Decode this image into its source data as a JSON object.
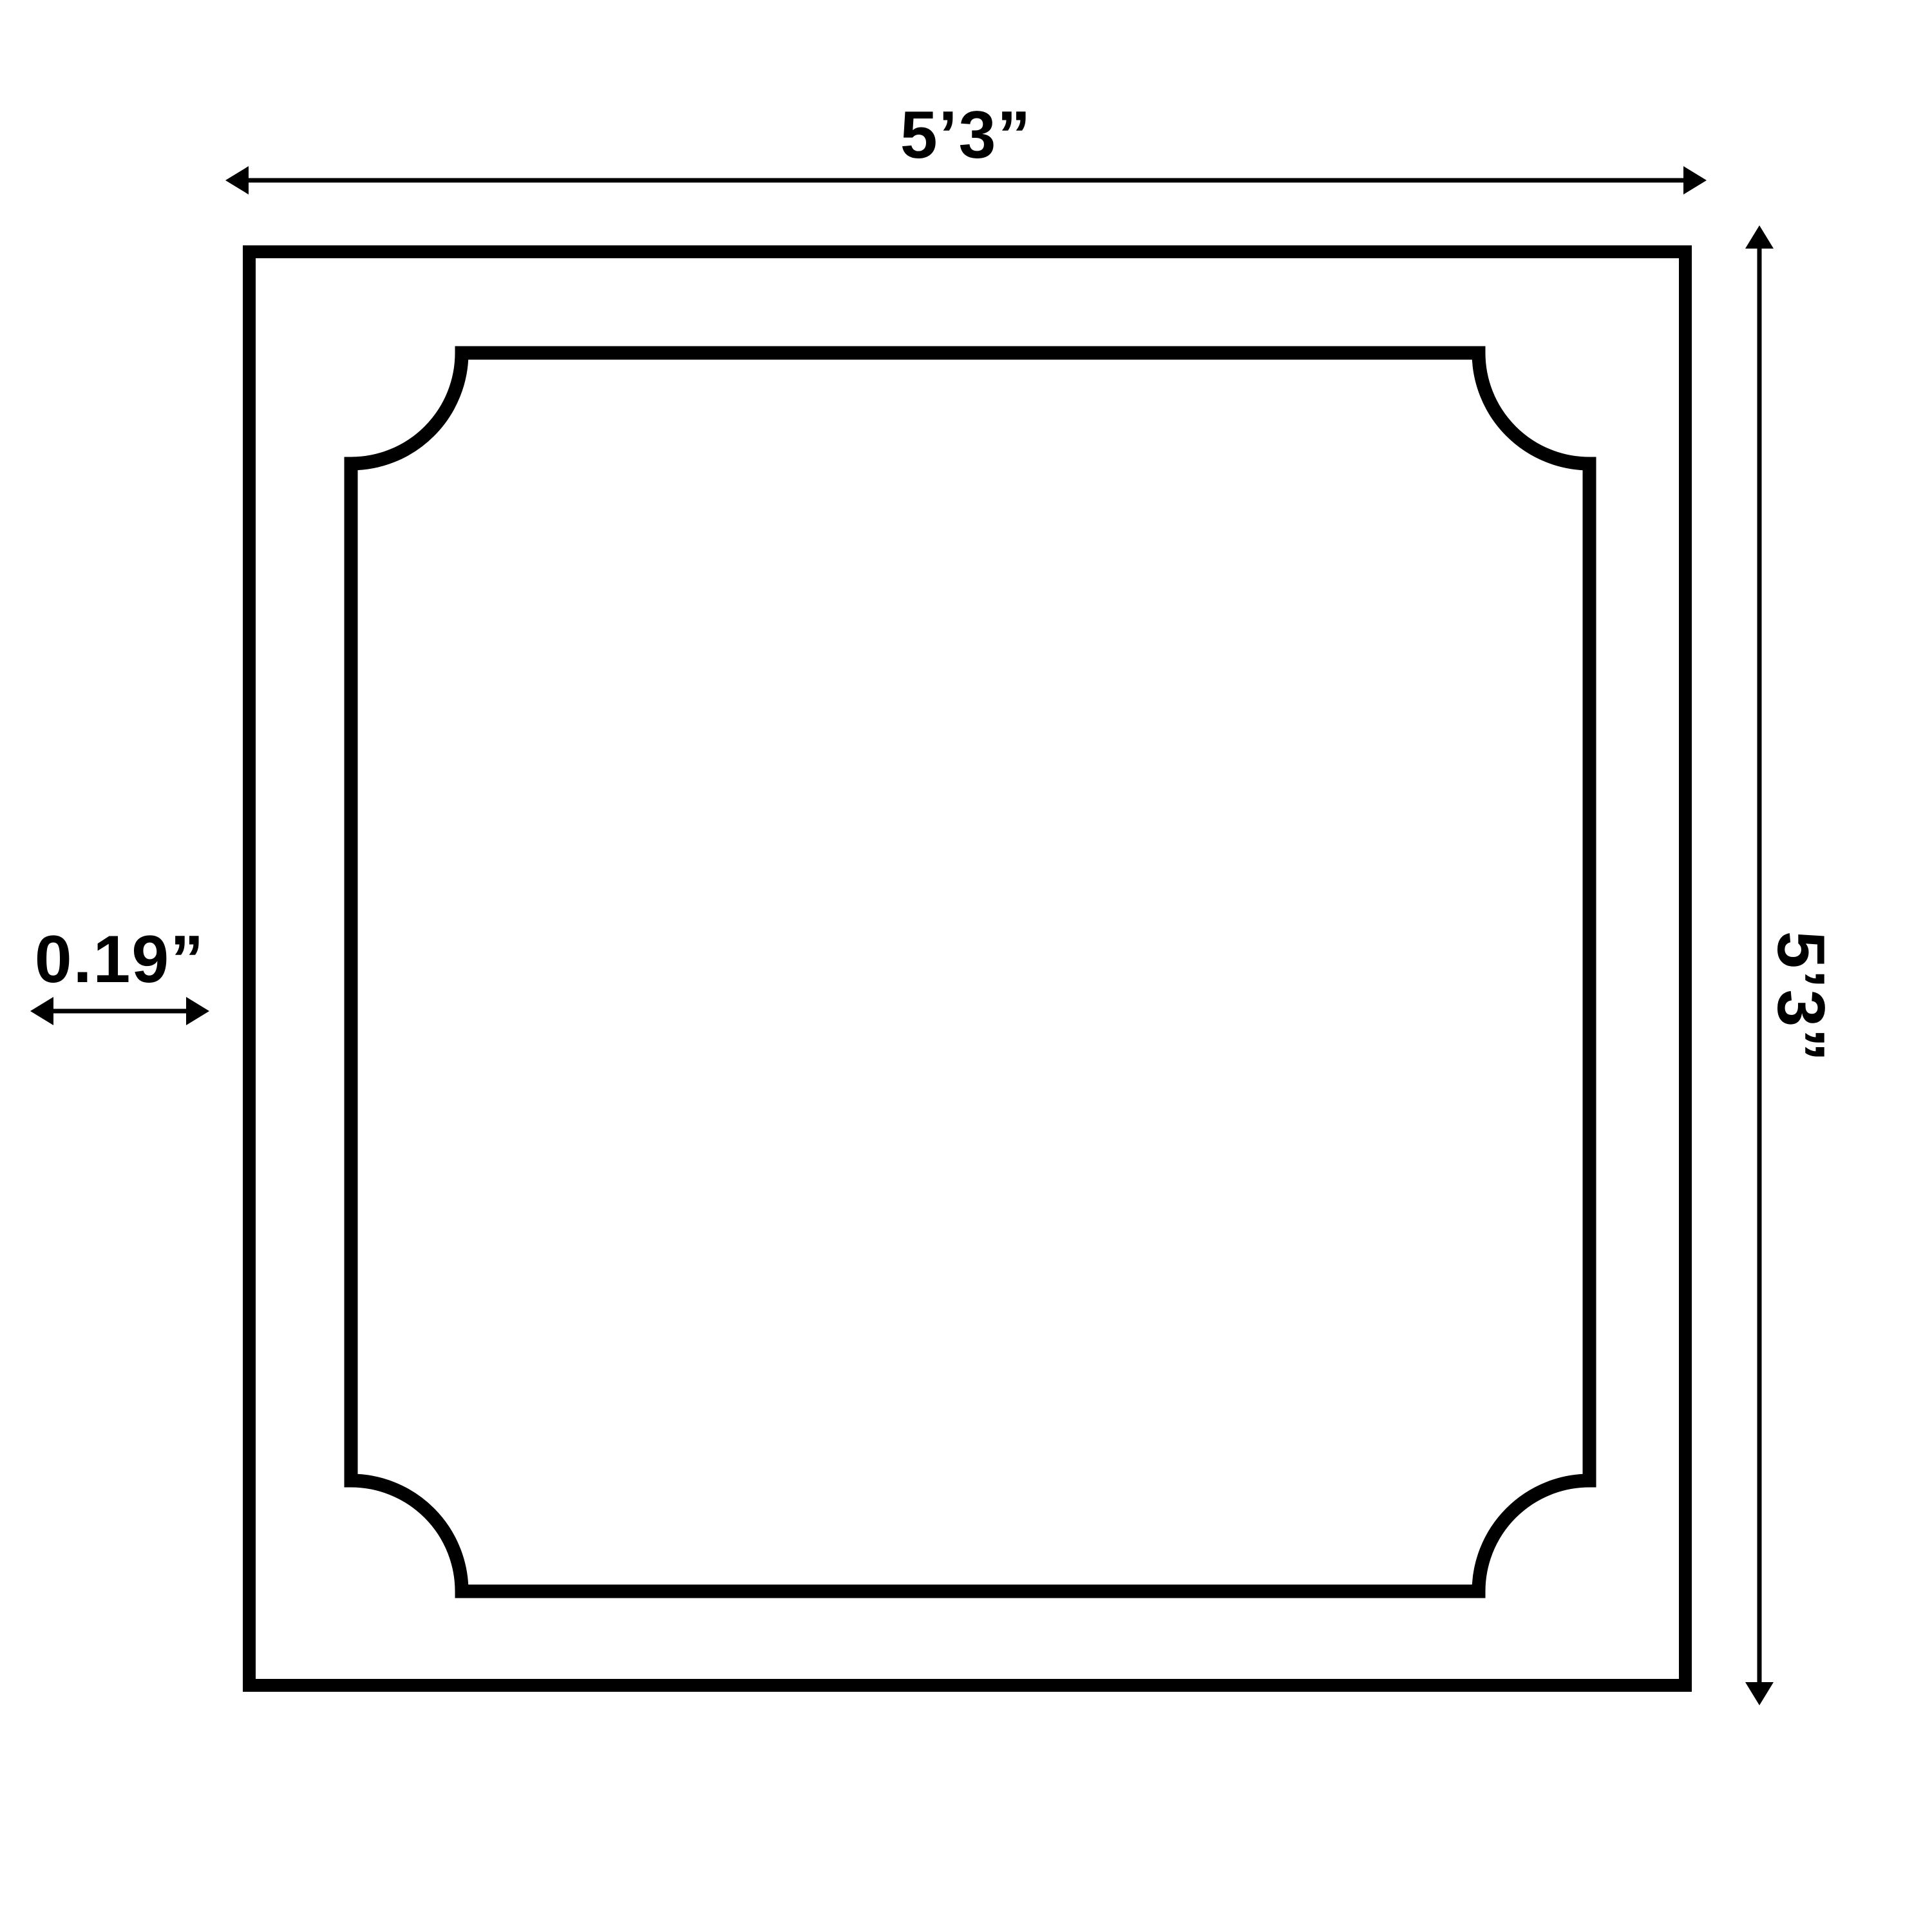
{
  "page": {
    "background": "#ffffff"
  },
  "diagram": {
    "line_color": "#000000",
    "labels": {
      "width": "5’3”",
      "height": "5’3”",
      "thickness": "0.19”"
    }
  }
}
